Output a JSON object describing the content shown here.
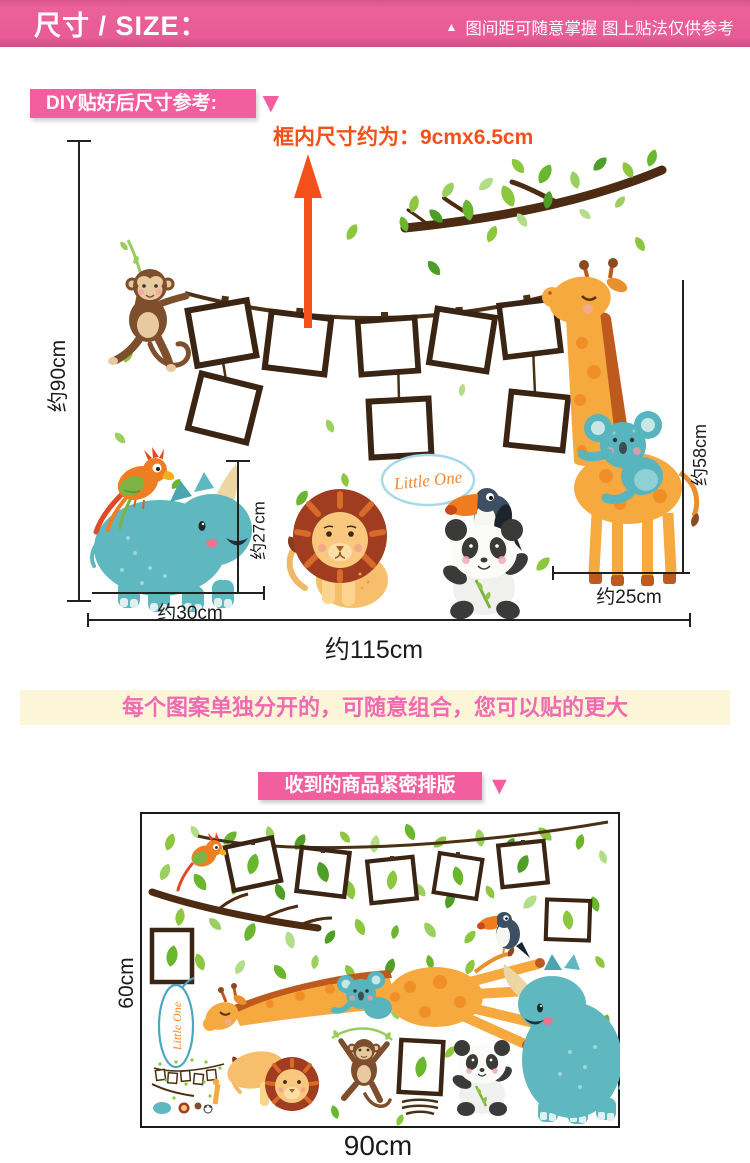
{
  "header": {
    "title": "尺寸 / SIZE：",
    "note": "图间距可随意掌握 图上贴法仅供参考"
  },
  "icons": {
    "triangle_up": "▲",
    "triangle_down": "▼"
  },
  "diy": {
    "label": "DIY贴好后尺寸参考:",
    "frame_note": "框内尺寸约为：9cmx6.5cm"
  },
  "diagram": {
    "bubble": "Little One",
    "dims": {
      "total_height": "约90cm",
      "total_width": "约115cm",
      "giraffe_height": "约58cm",
      "giraffe_width": "约25cm",
      "rhino_horn_height": "约27cm",
      "rhino_width": "约30cm"
    }
  },
  "banner": {
    "text": "每个图案单独分开的，可随意组合，您可以贴的更大"
  },
  "packed": {
    "ribbon": "收到的商品紧密排版",
    "bubble": "Little One",
    "dims": {
      "height": "60cm",
      "width": "90cm"
    }
  },
  "colors": {
    "pink": "#f35f9e",
    "orange": "#f4511a",
    "banner_bg": "#fcf5d8",
    "teal": "#5fb7bf",
    "giraffe_orange": "#f6a93f",
    "frame_brown": "#3a2514"
  }
}
